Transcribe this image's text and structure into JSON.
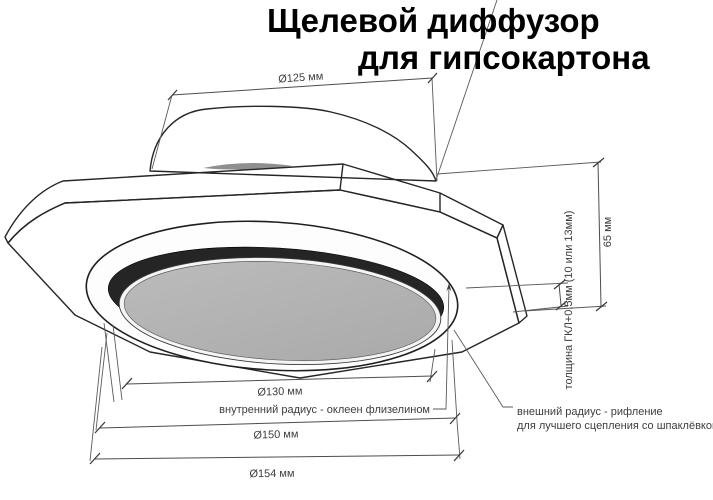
{
  "title": {
    "line1": "Щелевой диффузор",
    "line2": "для гипсокартона"
  },
  "dimensions": {
    "duct_diameter": "Ø125 мм",
    "inner_plate_diameter": "Ø130 мм",
    "ring_diameter": "Ø150 мм",
    "outer_diameter": "Ø154 мм",
    "height": "65 мм",
    "panel_thickness": "толщина ГКЛ+0,5мм (10 или 13мм)"
  },
  "annotations": {
    "inner_radius": "внутренний радиус - оклеен флизелином",
    "outer_radius_line1": "внешний радиус - рифление",
    "outer_radius_line2": "для лучшего сцепления со шпаклёвкой"
  },
  "colors": {
    "background": "#ffffff",
    "outline": "#262626",
    "dimension_line": "#4d4d4d",
    "label_text": "#3d3d3d",
    "panel_underside": "#c6c6c6",
    "panel_edge_band": "#fbfbfb",
    "panel_side_face": "#a6a6a6",
    "slot_ring": "#252525",
    "inner_plate": "#b3b3b3",
    "outer_ring": "#fdfdfd"
  }
}
